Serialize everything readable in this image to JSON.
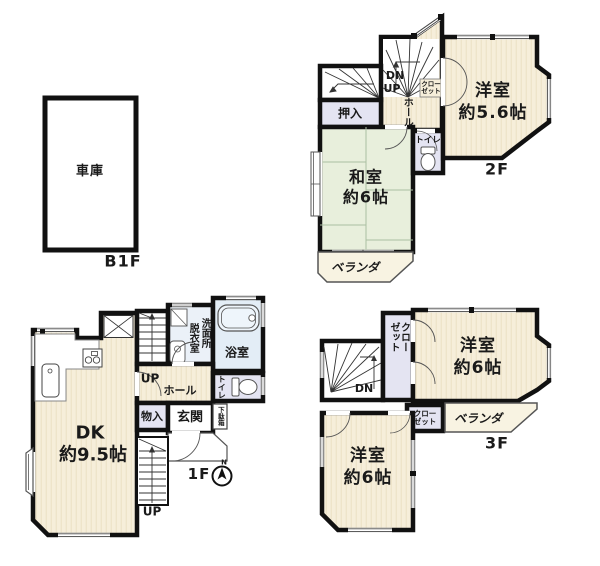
{
  "title": "間取り図 (floor plan)",
  "colors": {
    "wall": "#111111",
    "western_room_fill": "#f6eeda",
    "western_room_stripe": "#ebdfc4",
    "tatami_fill": "#e8efdc",
    "closet_fill": "#e4e4f2",
    "bath_fill": "#e3edf6",
    "veranda_fill": "#f8f3e2",
    "thin_line": "#555555"
  },
  "b1f": {
    "garage": "車庫",
    "floor": "B1F"
  },
  "f1": {
    "dk_name": "DK",
    "dk_size": "約9.5帖",
    "up_mid": "UP",
    "up_bottom": "UP",
    "hall": "ホール",
    "datsuishitsu": "脱衣室",
    "senmenjo": "洗面所",
    "bathroom": "浴室",
    "toilet": "トイレ",
    "monoire": "物入",
    "genkan": "玄関",
    "getabako": "下駄箱",
    "floor": "1F",
    "compass_north": "N"
  },
  "f2": {
    "room1_name": "洋室",
    "room1_size": "約5.6帖",
    "washitsu_name": "和室",
    "washitsu_size": "約6帖",
    "oshiire": "押入",
    "toilet": "トイレ",
    "dn": "DN",
    "up": "UP",
    "hall": "ホール",
    "closet": "クローゼット",
    "veranda": "ベランダ",
    "floor": "2F"
  },
  "f3": {
    "room1_name": "洋室",
    "room1_size": "約6帖",
    "room2_name": "洋室",
    "room2_size": "約6帖",
    "closet_tall": "クローゼット",
    "closet_small": "クローゼット",
    "dn": "DN",
    "veranda": "ベランダ",
    "floor": "3F"
  }
}
